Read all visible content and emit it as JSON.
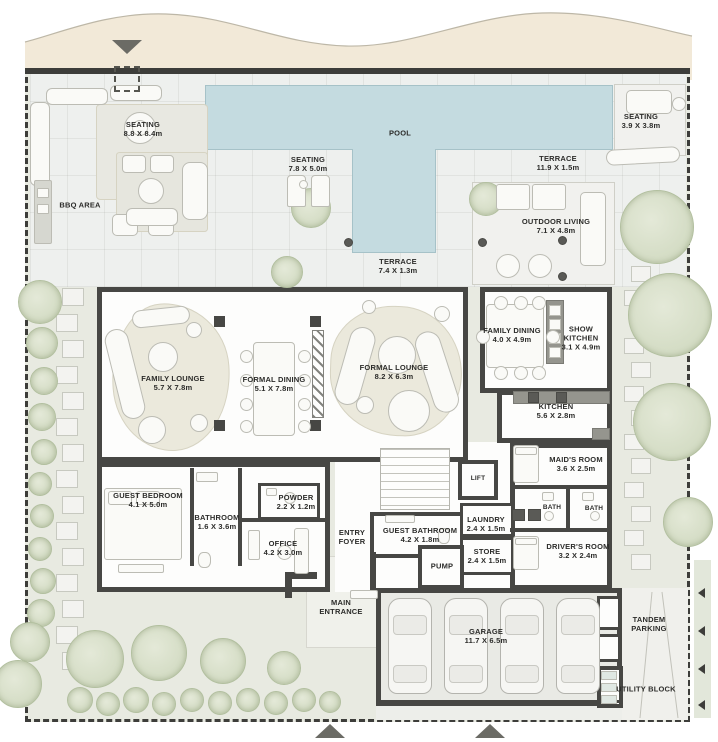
{
  "title": "Villa Ground Floor Plan",
  "labels": [
    {
      "text": "SEATING",
      "dims": "8.8 X 8.4m",
      "x": 143,
      "y": 129
    },
    {
      "text": "BBQ AREA",
      "dims": "",
      "x": 80,
      "y": 205
    },
    {
      "text": "POOL",
      "dims": "",
      "x": 400,
      "y": 133
    },
    {
      "text": "SEATING",
      "dims": "7.8 X 5.0m",
      "x": 308,
      "y": 164
    },
    {
      "text": "TERRACE",
      "dims": "11.9 X 1.5m",
      "x": 558,
      "y": 163
    },
    {
      "text": "SEATING",
      "dims": "3.9 X 3.8m",
      "x": 641,
      "y": 121
    },
    {
      "text": "OUTDOOR LIVING",
      "dims": "7.1 X 4.8m",
      "x": 556,
      "y": 226
    },
    {
      "text": "TERRACE",
      "dims": "7.4 X 1.3m",
      "x": 398,
      "y": 266
    },
    {
      "text": "FAMILY LOUNGE",
      "dims": "5.7 X 7.8m",
      "x": 173,
      "y": 383
    },
    {
      "text": "FORMAL DINING",
      "dims": "5.1 X 7.8m",
      "x": 274,
      "y": 384
    },
    {
      "text": "FORMAL LOUNGE",
      "dims": "8.2 X 6.3m",
      "x": 394,
      "y": 372
    },
    {
      "text": "FAMILY DINING",
      "dims": "4.0 X 4.9m",
      "x": 512,
      "y": 335,
      "w": 62,
      "wrap": true
    },
    {
      "text": "SHOW KITCHEN",
      "dims": "3.1 X 4.9m",
      "x": 581,
      "y": 338,
      "w": 46,
      "wrap": true
    },
    {
      "text": "KITCHEN",
      "dims": "5.6 X 2.8m",
      "x": 556,
      "y": 411
    },
    {
      "text": "MAID'S ROOM",
      "dims": "3.6 X 2.5m",
      "x": 576,
      "y": 464
    },
    {
      "text": "LIFT",
      "dims": "",
      "x": 478,
      "y": 479,
      "fs": 6.5
    },
    {
      "text": "BATH",
      "dims": "",
      "x": 552,
      "y": 508,
      "fs": 6.5
    },
    {
      "text": "BATH",
      "dims": "",
      "x": 594,
      "y": 509,
      "fs": 6.5
    },
    {
      "text": "DRIVER'S ROOM",
      "dims": "3.2 X 2.4m",
      "x": 578,
      "y": 551
    },
    {
      "text": "LAUNDRY",
      "dims": "2.4 X 1.5m",
      "x": 486,
      "y": 524
    },
    {
      "text": "STORE",
      "dims": "2.4 X 1.5m",
      "x": 487,
      "y": 556
    },
    {
      "text": "GUEST BATHROOM",
      "dims": "4.2 X 1.8m",
      "x": 420,
      "y": 535
    },
    {
      "text": "PUMP",
      "dims": "",
      "x": 442,
      "y": 566
    },
    {
      "text": "ENTRY FOYER",
      "dims": "",
      "x": 352,
      "y": 537,
      "w": 42,
      "wrap": true
    },
    {
      "text": "GUEST BEDROOM",
      "dims": "4.1 X 5.0m",
      "x": 148,
      "y": 500
    },
    {
      "text": "BATHROOM",
      "dims": "1.6 X 3.6m",
      "x": 217,
      "y": 522
    },
    {
      "text": "POWDER",
      "dims": "2.2 X 1.2m",
      "x": 296,
      "y": 502
    },
    {
      "text": "OFFICE",
      "dims": "4.2 X 3.0m",
      "x": 283,
      "y": 548
    },
    {
      "text": "MAIN ENTRANCE",
      "dims": "",
      "x": 341,
      "y": 607,
      "w": 54,
      "wrap": true
    },
    {
      "text": "GARAGE",
      "dims": "11.7 X 6.5m",
      "x": 486,
      "y": 636
    },
    {
      "text": "TANDEM PARKING",
      "dims": "",
      "x": 649,
      "y": 624,
      "w": 50,
      "wrap": true
    },
    {
      "text": "UTILITY BLOCK",
      "dims": "",
      "x": 646,
      "y": 689
    }
  ],
  "icons": {
    "top_arrow": "entrance-arrow-down",
    "bottom_arrows": [
      "driveway-arrow-up",
      "driveway-arrow-up"
    ]
  },
  "colors": {
    "pool": "#c4dbe0",
    "wall": "#474744",
    "sand_band": "#f2e9d8",
    "garden": "#e8eae1",
    "deck": "#eef0ee",
    "tree": "#ccd6bb"
  }
}
